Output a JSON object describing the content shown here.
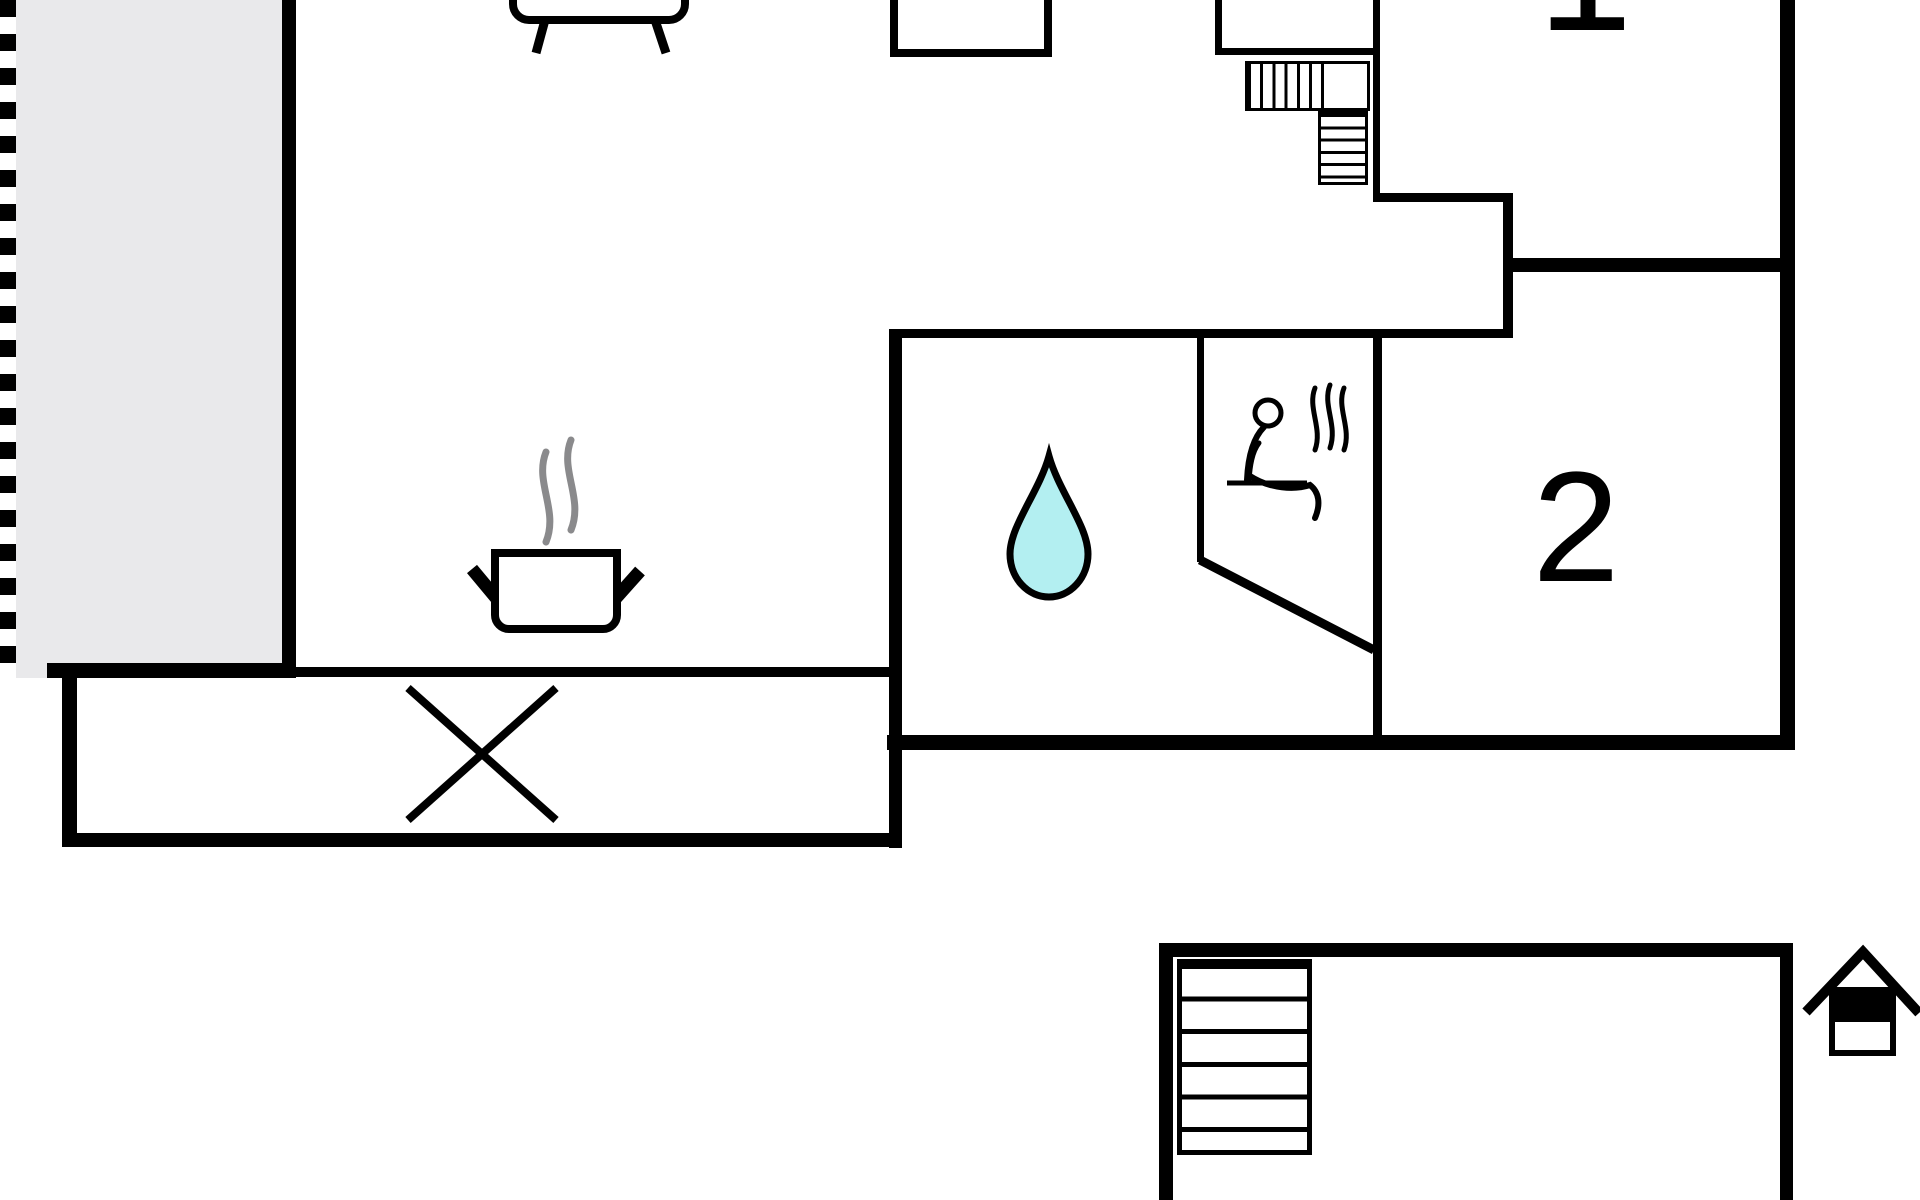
{
  "floor_plan": {
    "description": "Black-and-white architectural floor plan, cut off at top and bottom edges",
    "background": "#ffffff"
  },
  "theme": {
    "wall_color": "#000000",
    "terrace_fill": "#e9e9eb",
    "water_drop_fill": "#b3eff1",
    "steam_color": "#8a8a8c",
    "label_color": "#000000"
  },
  "rooms": {
    "bedroom_1": {
      "label": "1"
    },
    "bedroom_2": {
      "label": "2"
    }
  },
  "icons": {
    "sofa": "sofa",
    "stove_pot": "steaming pot on stove",
    "water_drop": "water drop (bathroom)",
    "sauna_person": "person in sauna with heat waves",
    "stairs_upper": "L-shaped staircase",
    "stairs_basement": "basement staircase",
    "x_marker": "x marker (void area)",
    "house": "house orientation symbol"
  }
}
